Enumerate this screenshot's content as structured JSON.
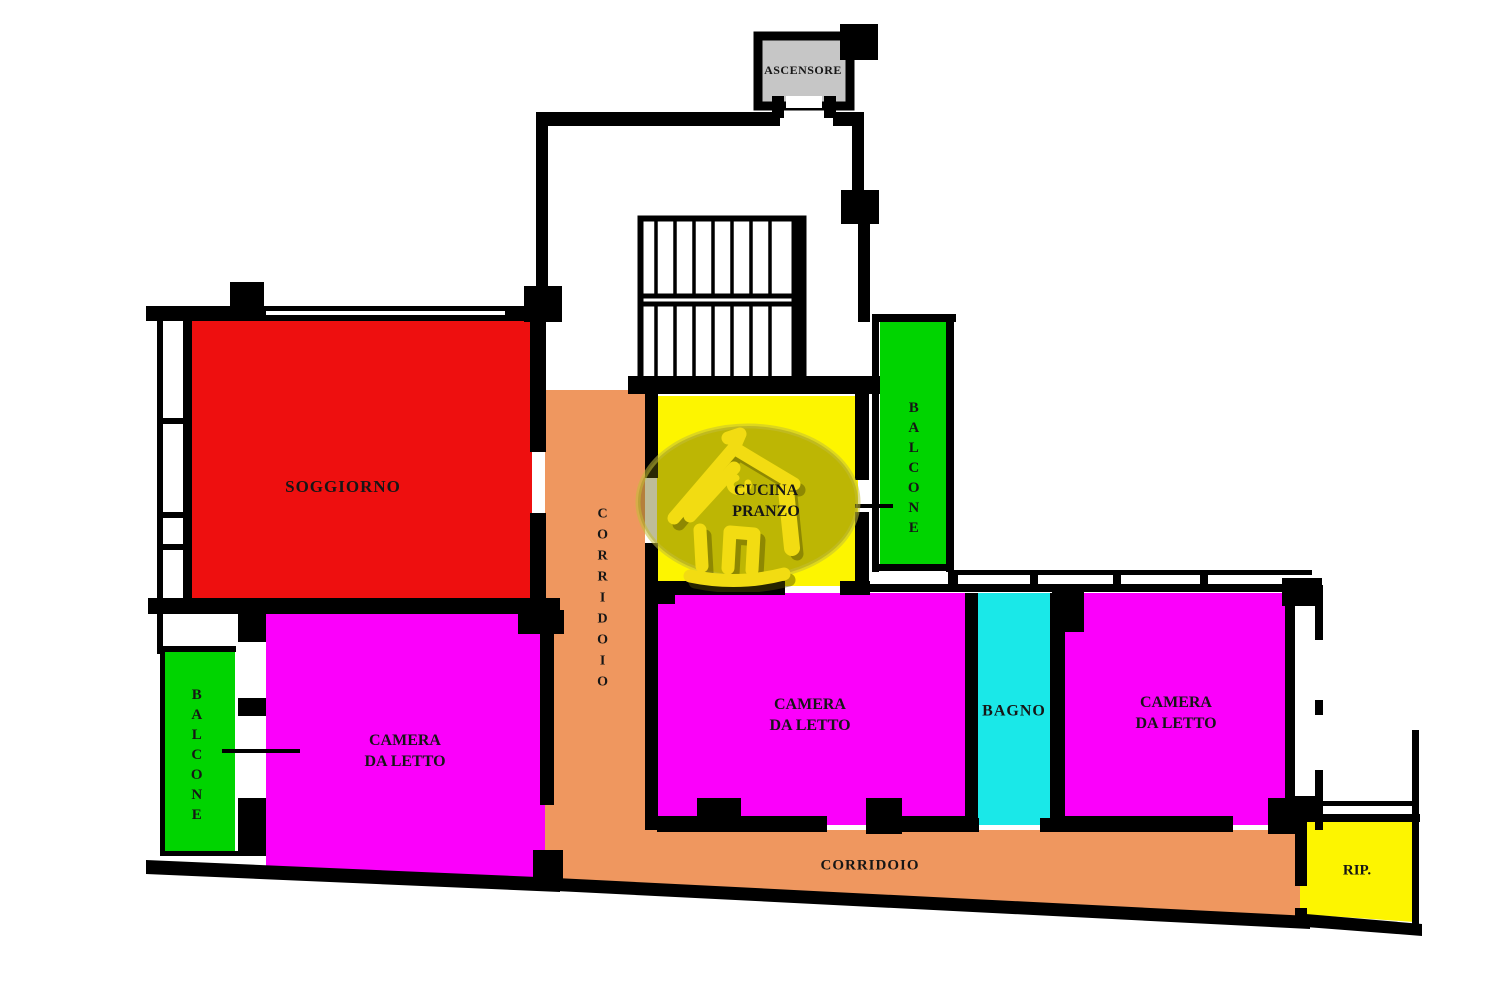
{
  "colors": {
    "wall": "#000000",
    "soggiorno": "#ee0f0f",
    "bedroom": "#fb00fb",
    "balcony": "#00d400",
    "kitchen": "#fdf500",
    "bathroom": "#1ae8e8",
    "corridor": "#ef975f",
    "storage": "#fdf500",
    "elevator": "#c6c6c6"
  },
  "rooms": {
    "ascensore": {
      "label": "ASCENSORE"
    },
    "soggiorno": {
      "label": "SOGGIORNO"
    },
    "cucina": {
      "line1": "CUCINA",
      "line2": "PRANZO"
    },
    "balcone_ovest": {
      "label": "BALCONE"
    },
    "balcone_nord": {
      "label": "BALCONE"
    },
    "corridoio_verticale": {
      "label": "CORRIDOIO"
    },
    "corridoio_orizzontale": {
      "label": "CORRIDOIO"
    },
    "camera_sinistra": {
      "line1": "CAMERA",
      "line2": "DA LETTO"
    },
    "camera_centrale": {
      "line1": "CAMERA",
      "line2": "DA LETTO"
    },
    "camera_destra": {
      "line1": "CAMERA",
      "line2": "DA LETTO"
    },
    "bagno": {
      "label": "BAGNO"
    },
    "ripostiglio": {
      "label": "RIP."
    }
  },
  "icons": {
    "watermark": "house-logo-icon"
  }
}
